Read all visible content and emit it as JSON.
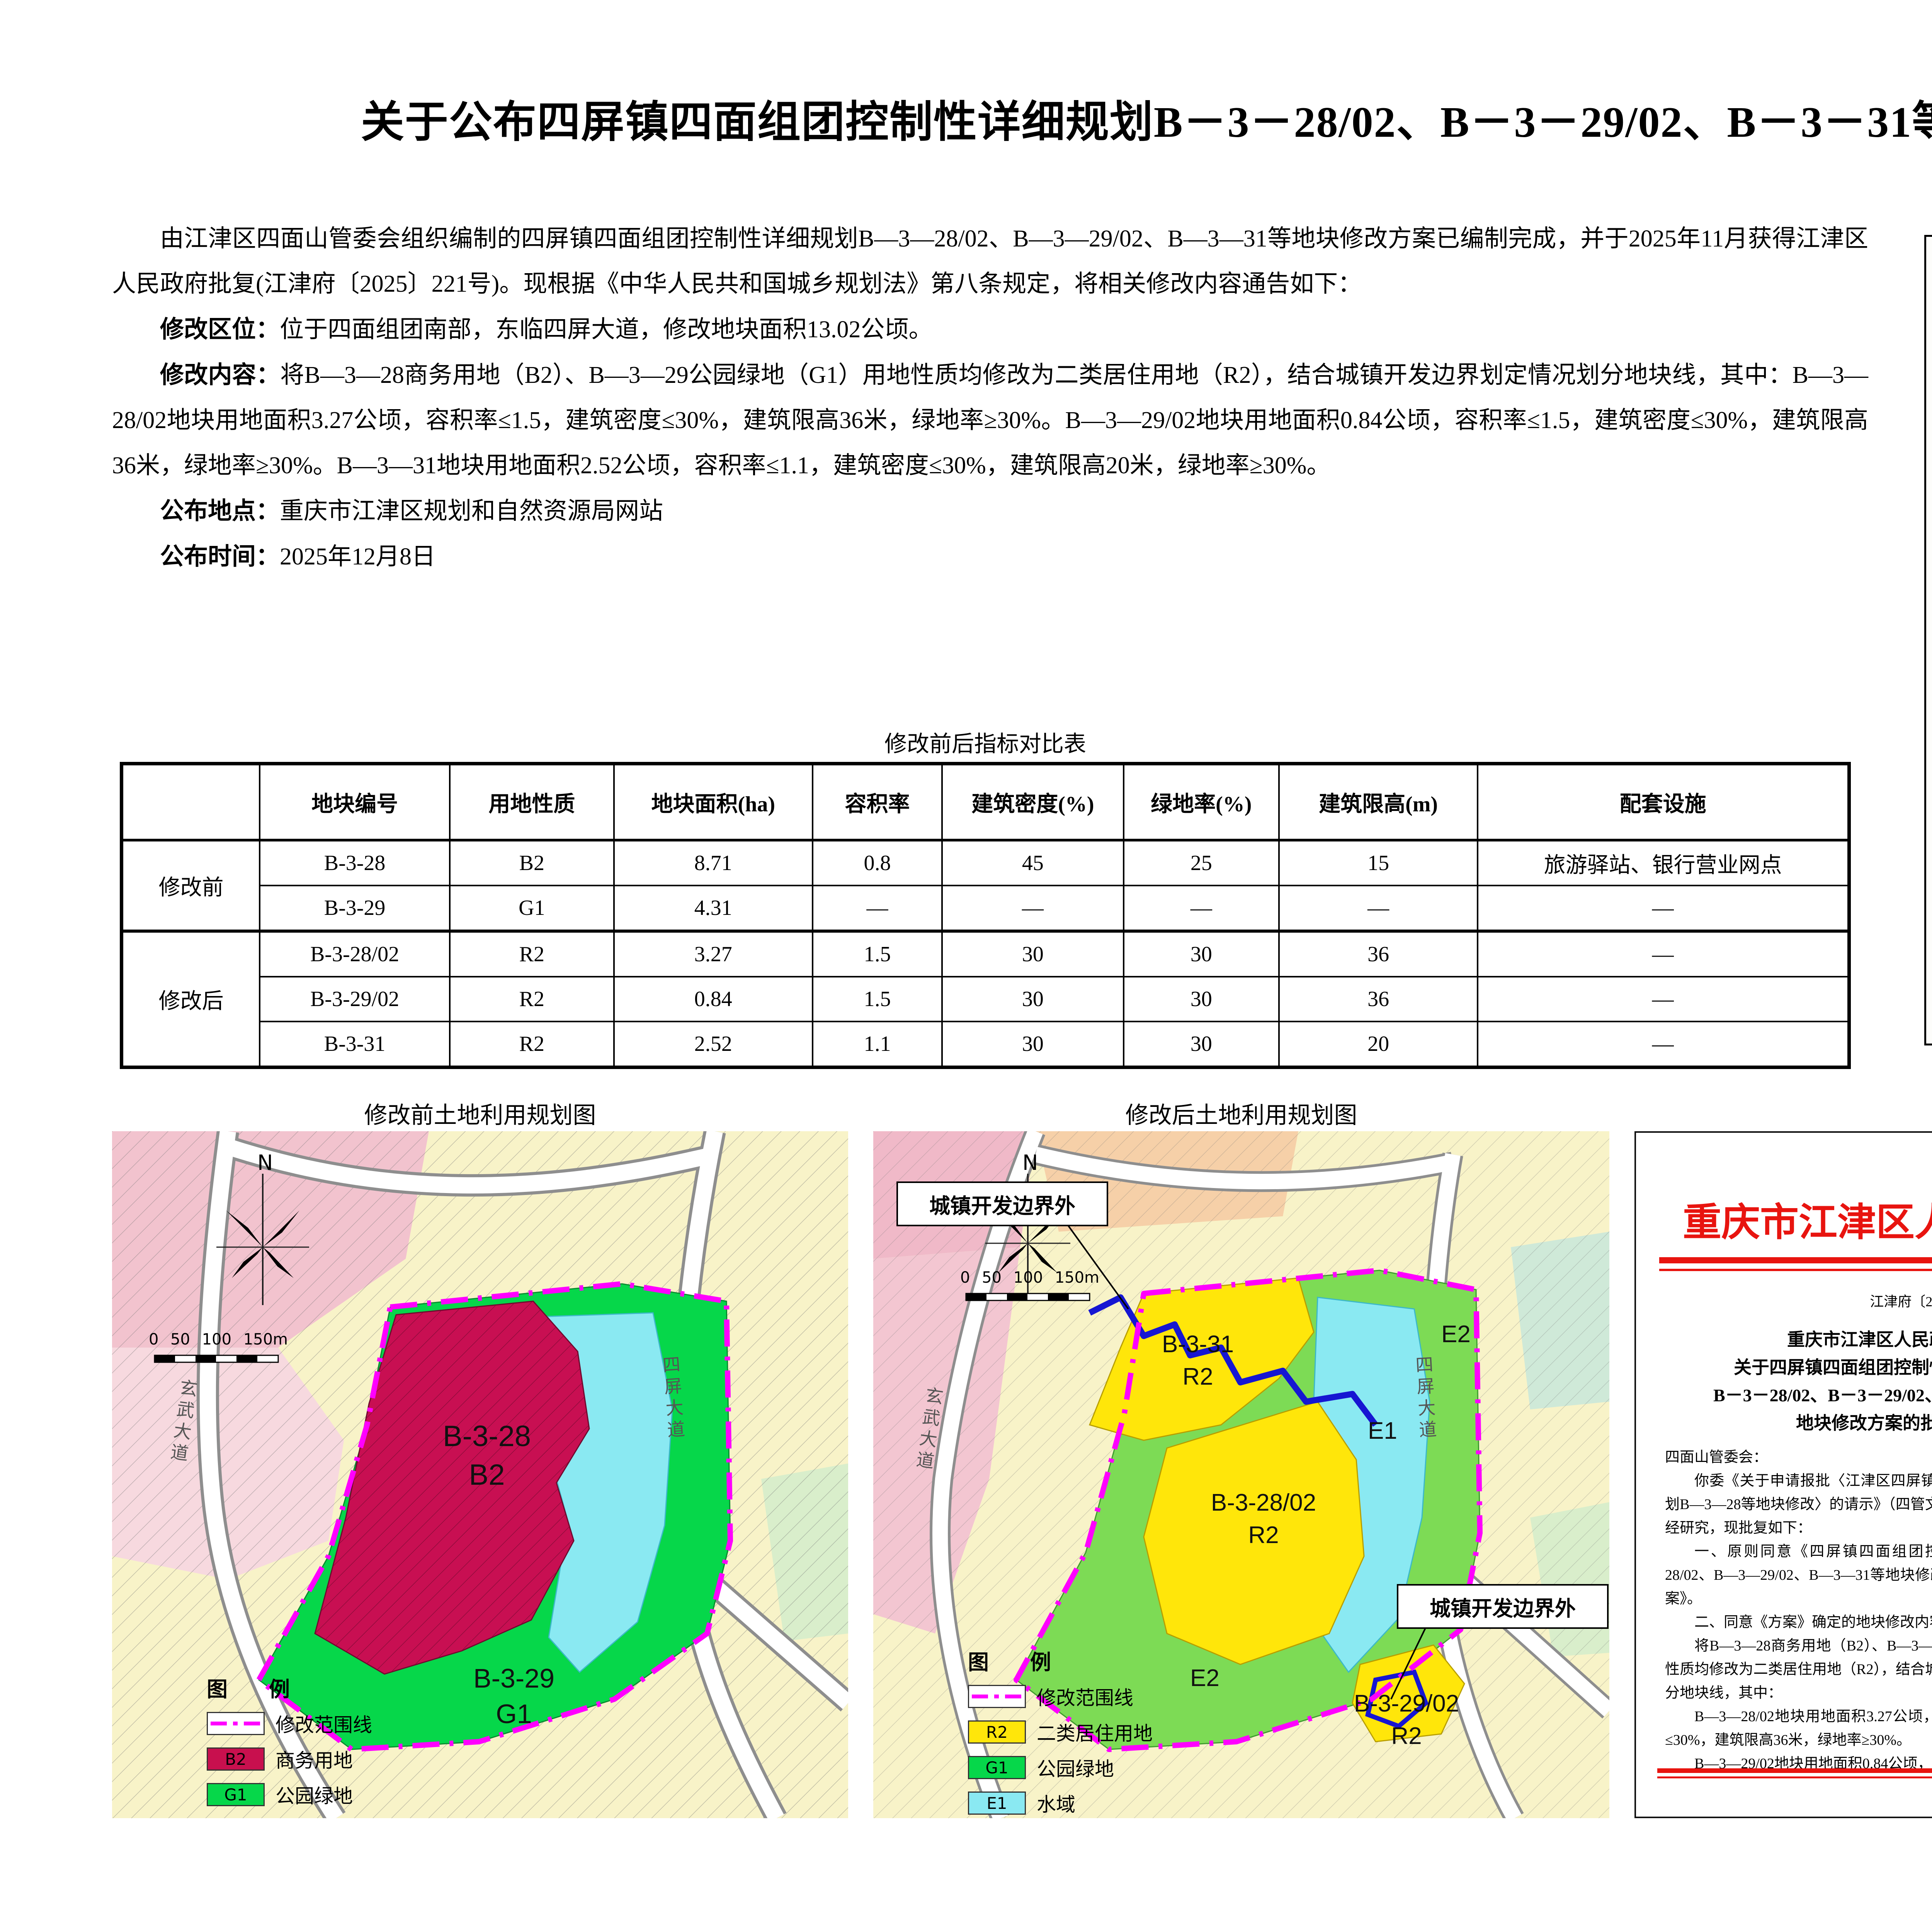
{
  "page": {
    "title": "关于公布四屏镇四面组团控制性详细规划B－3－28/02、B－3－29/02、B－3－31等地块修改方案的通告"
  },
  "notice": {
    "intro": "由江津区四面山管委会组织编制的四屏镇四面组团控制性详细规划B—3—28/02、B—3—29/02、B—3—31等地块修改方案已编制完成，并于2025年11月获得江津区人民政府批复(江津府〔2025〕221号)。现根据《中华人民共和国城乡规划法》第八条规定，将相关修改内容通告如下：",
    "items": [
      {
        "label": "修改区位：",
        "text": "位于四面组团南部，东临四屏大道，修改地块面积13.02公顷。"
      },
      {
        "label": "修改内容：",
        "text": "将B—3—28商务用地（B2）、B—3—29公园绿地（G1）用地性质均修改为二类居住用地（R2），结合城镇开发边界划定情况划分地块线，其中：B—3—28/02地块用地面积3.27公顷，容积率≤1.5，建筑密度≤30%，建筑限高36米，绿地率≥30%。B—3—29/02地块用地面积0.84公顷，容积率≤1.5，建筑密度≤30%，建筑限高36米，绿地率≥30%。B—3—31地块用地面积2.52公顷，容积率≤1.1，建筑密度≤30%，建筑限高20米，绿地率≥30%。"
      },
      {
        "label": "公布地点：",
        "text": "重庆市江津区规划和自然资源局网站"
      },
      {
        "label": "公布时间：",
        "text": "2025年12月8日"
      }
    ]
  },
  "table": {
    "title": "修改前后指标对比表",
    "headers": [
      "地块编号",
      "用地性质",
      "地块面积(ha)",
      "容积率",
      "建筑密度(%)",
      "绿地率(%)",
      "建筑限高(m)",
      "配套设施"
    ],
    "groups": [
      {
        "label": "修改前",
        "rows": [
          [
            "B-3-28",
            "B2",
            "8.71",
            "0.8",
            "45",
            "25",
            "15",
            "旅游驿站、银行营业网点"
          ],
          [
            "B-3-29",
            "G1",
            "4.31",
            "—",
            "—",
            "—",
            "—",
            "—"
          ]
        ]
      },
      {
        "label": "修改后",
        "rows": [
          [
            "B-3-28/02",
            "R2",
            "3.27",
            "1.5",
            "30",
            "30",
            "36",
            "—"
          ],
          [
            "B-3-29/02",
            "R2",
            "0.84",
            "1.5",
            "30",
            "30",
            "36",
            "—"
          ],
          [
            "B-3-31",
            "R2",
            "2.52",
            "1.1",
            "30",
            "30",
            "20",
            "—"
          ]
        ]
      }
    ]
  },
  "location_map": {
    "title": "区位图",
    "compass": "N",
    "scale_ticks": [
      "0",
      "50",
      "100",
      "150m"
    ],
    "callout": "修改地块",
    "roads": [
      {
        "name": "玄武大道",
        "color": "#e60000"
      },
      {
        "name": "四屏大道",
        "color": "#1515cc"
      },
      {
        "name": "银岩路",
        "color": "#a3a3a3"
      }
    ]
  },
  "before_map": {
    "title": "修改前土地利用规划图",
    "compass": "N",
    "scale_ticks": [
      "0",
      "50",
      "100",
      "150m"
    ],
    "plot_labels": [
      {
        "code": "B-3-28",
        "use": "B2"
      },
      {
        "code": "B-3-29",
        "use": "G1"
      }
    ],
    "roads": [
      "玄武大道",
      "四屏大道"
    ],
    "legend": {
      "title": "图  例",
      "items": [
        {
          "code": "",
          "label": "修改范围线",
          "color": "#ff00ff"
        },
        {
          "code": "B2",
          "label": "商务用地",
          "color": "#c8104e"
        },
        {
          "code": "G1",
          "label": "公园绿地",
          "color": "#06d74a"
        },
        {
          "code": "",
          "label": "城镇开发边界",
          "color": "hatch"
        }
      ]
    }
  },
  "after_map": {
    "title": "修改后土地利用规划图",
    "compass": "N",
    "scale_ticks": [
      "0",
      "50",
      "100",
      "150m"
    ],
    "callouts": [
      "城镇开发边界外",
      "城镇开发边界外"
    ],
    "plot_labels": [
      {
        "code": "B-3-31",
        "use": "R2"
      },
      {
        "code": "B-3-28/02",
        "use": "R2"
      },
      {
        "code": "B-3-29/02",
        "use": "R2"
      },
      {
        "code": "E1",
        "use": ""
      },
      {
        "code": "E2",
        "use": ""
      },
      {
        "code": "E2",
        "use": ""
      }
    ],
    "roads": [
      "玄武大道",
      "四屏大道"
    ],
    "legend": {
      "title": "图  例",
      "items": [
        {
          "code": "",
          "label": "修改范围线",
          "color": "#ff00ff"
        },
        {
          "code": "R2",
          "label": "二类居住用地",
          "color": "#ffe60a"
        },
        {
          "code": "G1",
          "label": "公园绿地",
          "color": "#06d74a"
        },
        {
          "code": "E1",
          "label": "水域",
          "color": "#8ae9f2"
        },
        {
          "code": "E2",
          "label": "农林用地",
          "color": "#8ce468"
        }
      ]
    }
  },
  "approval": {
    "title": "批复文件",
    "page1": {
      "agency": "重庆市江津区人民政府",
      "doc_no": "江津府〔2025〕221号",
      "title_lines": [
        "重庆市江津区人民政府",
        "关于四屏镇四面组团控制性详细规划",
        "B－3－28/02、B－3－29/02、B－3－31 等",
        "地块修改方案的批复"
      ],
      "paragraphs": [
        "四面山管委会：",
        "你委《关于申请报批〈江津区四屏镇四面组团控制性详细规划B—3—28等地块修改〉的请示》（四管文〔2025〕40号）收悉。经研究，现批复如下：",
        "一、原则同意《四屏镇四面组团控制性详细规划B—3—28/02、B—3—29/02、B—3—31等地块修改方案》，以下简称《方案》。",
        "二、同意《方案》确定的地块修改内容：",
        "将B—3—28商务用地（B2）、B—3—29公园绿地（G1）用地性质均修改为二类居住用地（R2），结合城镇开发边界划定情况划分地块线，其中：",
        "B—3—28/02地块用地面积3.27公顷，容积率≤1.5，建筑密度≤30%，建筑限高36米，绿地率≥30%。",
        "B—3—29/02地块用地面积0.84公顷，容积率≤1.5，建筑"
      ]
    },
    "page2": {
      "paragraphs": [
        "密度≤30%，建筑限高36米，绿地率≥30%。",
        "B—3—31地块用地面积2.52公顷，容积率≤1.1，建筑密度≤30%，建筑限高20米，绿地率≥30%。",
        "请你委根据本批复，加强规划的控制和引导，严格依法监管，确保各项规划要求得到落实。任何单位和个人不得擅自更改，确需进行修改的，应按法定程序报批。"
      ],
      "signer": "重庆市江津区人民政府",
      "date": "2025 年 11 月 6 日",
      "cc": "抄送：江津区规划自然资源局。",
      "page_no": "— 2 —"
    }
  },
  "colors": {
    "b2_commercial": "#c8104e",
    "g1_park_green": "#06d74a",
    "r2_residential": "#ffe60a",
    "e1_water": "#8ae9f2",
    "e2_farm_forest": "#8ce468",
    "boundary_magenta": "#ff00ff",
    "dev_boundary_blue": "#1515cc",
    "road_red": "#e60000",
    "doc_red": "#e8140f"
  }
}
